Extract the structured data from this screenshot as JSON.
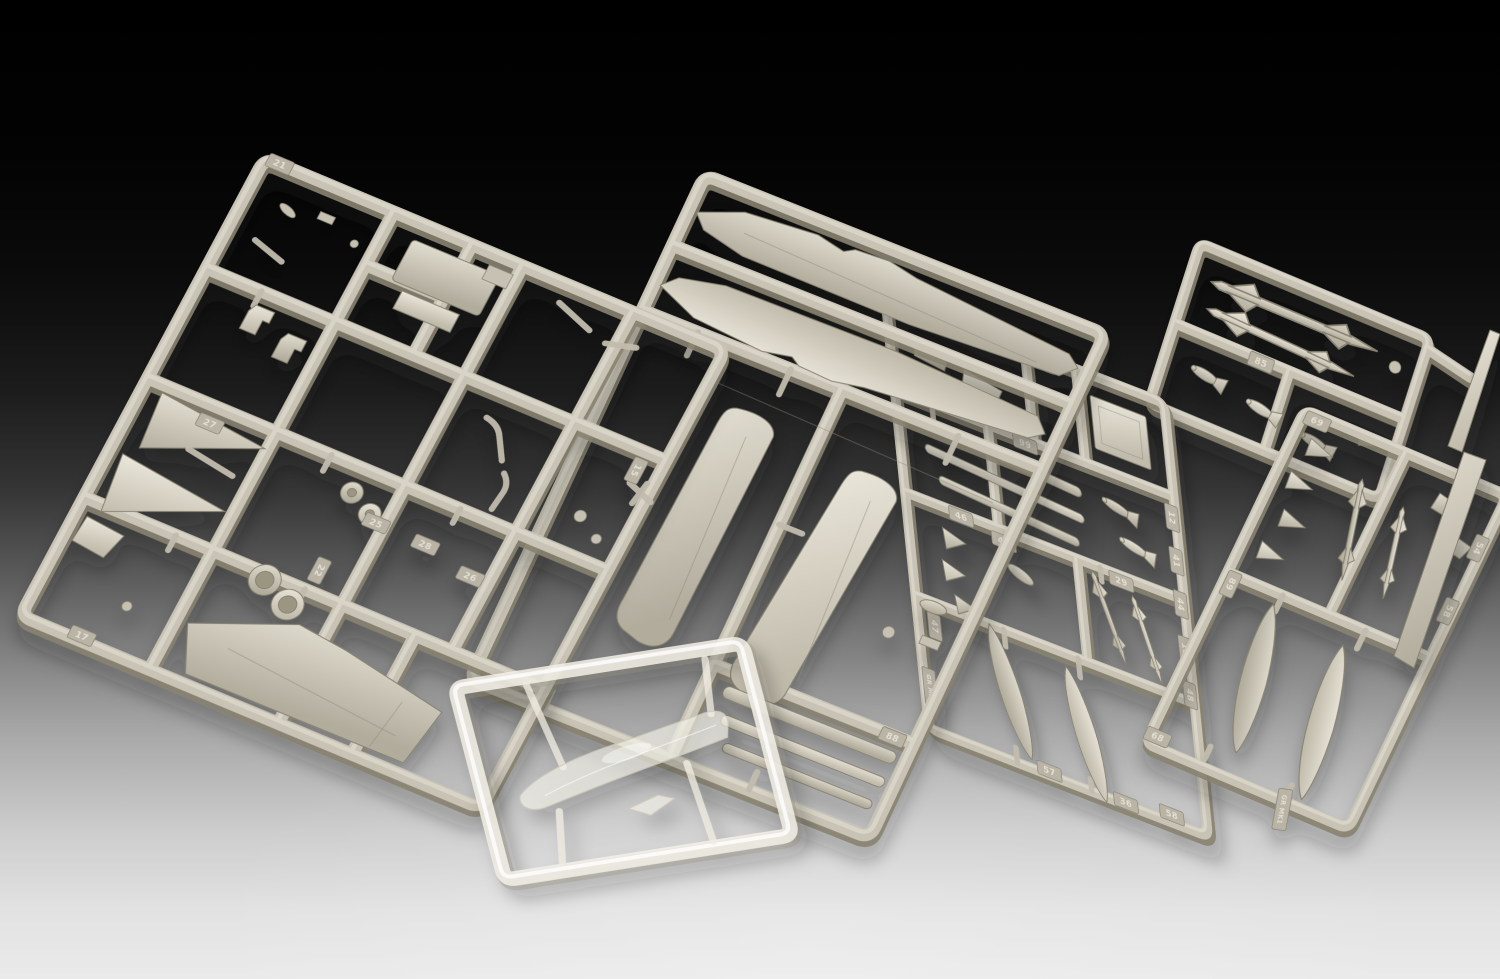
{
  "colors": {
    "background_top": "#000000",
    "background_upper_mid": "#1c1c1c",
    "background_lower_mid": "#7e7e7e",
    "background_bottom": "#eaeaea",
    "plastic_base": "#c8c3b4",
    "plastic_highlight": "#dedacd",
    "plastic_shadow": "#87826f",
    "clear_plastic": "#f3f0e7"
  },
  "sprues": [
    {
      "id": "A",
      "name": "airframe-small-parts-sprue",
      "tags": [
        {
          "label": "21"
        },
        {
          "label": "25"
        },
        {
          "label": "27"
        },
        {
          "label": "26"
        },
        {
          "label": "28"
        },
        {
          "label": "22"
        },
        {
          "label": "15"
        },
        {
          "label": "17"
        }
      ]
    },
    {
      "id": "B",
      "name": "fuselage-and-wings-sprue",
      "tags": [
        {
          "label": "88"
        }
      ]
    },
    {
      "id": "C",
      "name": "weapons-and-tanks-sprue",
      "tags": [
        {
          "label": "40A"
        },
        {
          "label": "87"
        },
        {
          "label": "99"
        },
        {
          "label": "46"
        },
        {
          "label": "29"
        },
        {
          "label": "42"
        },
        {
          "label": "12"
        },
        {
          "label": "41"
        },
        {
          "label": "44"
        },
        {
          "label": "18"
        },
        {
          "label": "48"
        },
        {
          "label": "58"
        },
        {
          "label": "36"
        },
        {
          "label": "47"
        },
        {
          "label": "GR MK1"
        },
        {
          "label": "57"
        }
      ]
    },
    {
      "id": "D",
      "name": "missiles-and-bombs-sprue",
      "tags": [
        {
          "label": "85"
        }
      ]
    },
    {
      "id": "E",
      "name": "drop-tanks-sprue",
      "tags": [
        {
          "label": "69"
        },
        {
          "label": "54"
        },
        {
          "label": "58"
        },
        {
          "label": "89"
        },
        {
          "label": "68"
        },
        {
          "label": "GR MK1"
        }
      ]
    },
    {
      "id": "F",
      "name": "clear-canopy-sprue",
      "tags": []
    }
  ]
}
